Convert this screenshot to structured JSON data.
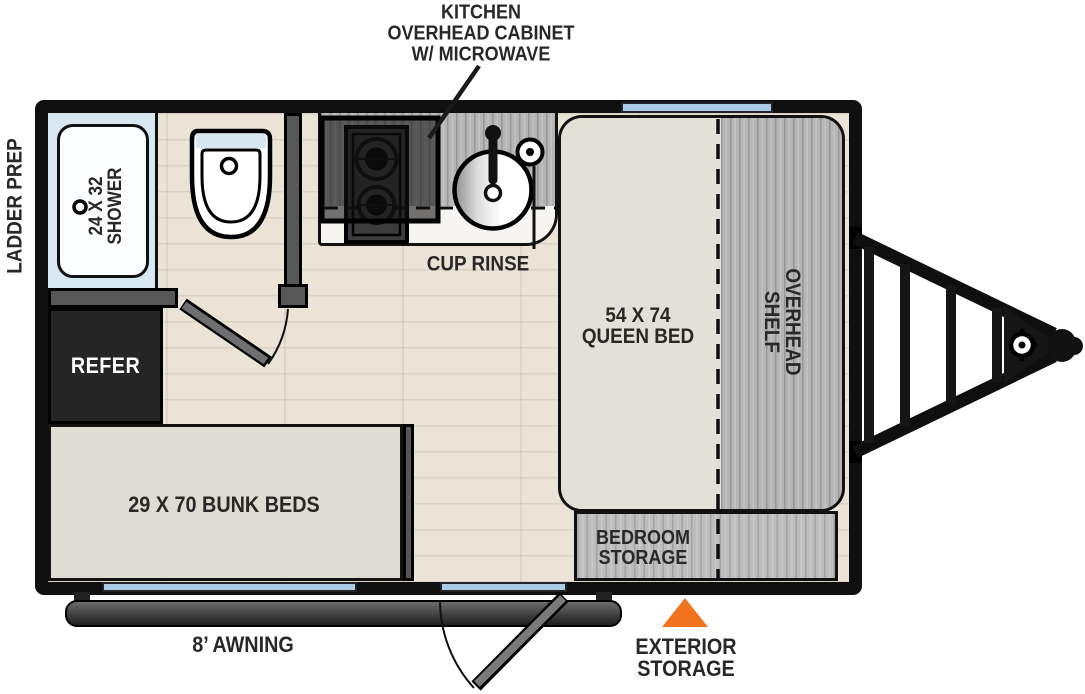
{
  "floorplan": {
    "callouts": {
      "kitchen_overhead": {
        "line1": "KITCHEN",
        "line2": "OVERHEAD CABINET",
        "line3": "W/ MICROWAVE"
      },
      "ladder_prep": "LADDER PREP",
      "cup_rinse": "CUP RINSE",
      "awning": "8’ AWNING",
      "exterior_storage": {
        "line1": "EXTERIOR",
        "line2": "STORAGE"
      }
    },
    "rooms": {
      "shower": {
        "line1": "24 X 32",
        "line2": "SHOWER"
      },
      "queen_bed": {
        "line1": "54 X 74",
        "line2": "QUEEN BED"
      },
      "overhead_shelf": {
        "line1": "OVERHEAD",
        "line2": "SHELF"
      },
      "refer": "REFER",
      "bunk_beds": "29 X 70 BUNK BEDS",
      "bedroom_storage": {
        "line1": "BEDROOM",
        "line2": "STORAGE"
      }
    },
    "colors": {
      "wall": "#0f0f0f",
      "interior_wall": "#575757",
      "window_glass": "#accbe7",
      "floor_wood": "#eae3d6",
      "cabinet_gray_wood": "#b5b5b5",
      "shower_blue": "#d8e8f2",
      "mattress": "#e3e0d8",
      "refrigerator": "#252525",
      "exterior_storage_marker": "#f1731f"
    }
  }
}
